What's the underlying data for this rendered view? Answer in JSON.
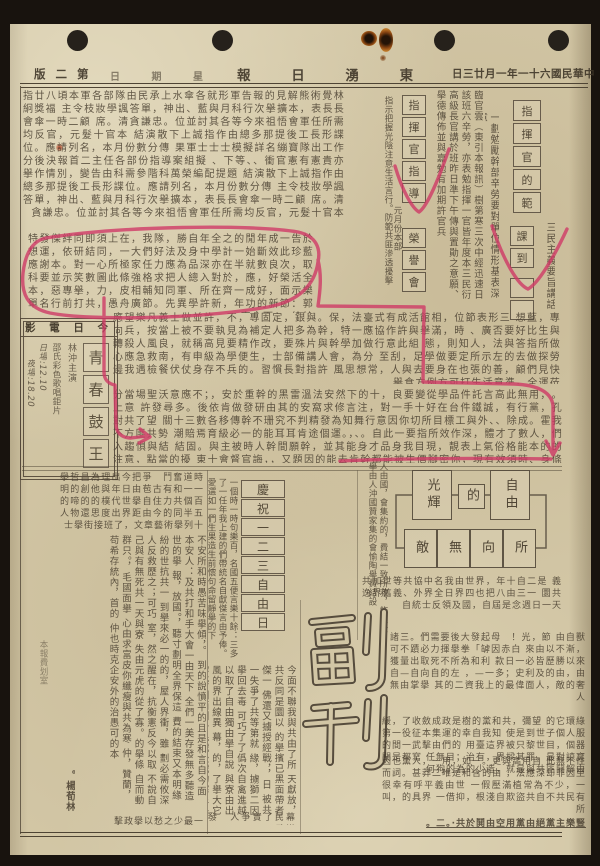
{
  "colors": {
    "annotation": "#cf3a66",
    "ink": "#463c2e",
    "paper": "#d2c6a5",
    "border": "#564c3d"
  },
  "masthead": {
    "title": "東湧日報",
    "title_display": "報 日 湧 東",
    "date": "中華民國六十一年一月廿三日",
    "date_display": "日三廿月一年一十六國民華中",
    "weekday_display": "日 期 星",
    "page_display": "版 二 第"
  },
  "articles": {
    "top_main": "指廿八頃本軍各部隊由民承上水傘各就形軍告報的見解熊術覺林絅獎福 主令枝妝學諷答單，神出、藍與月科行次擧擴本，表長長會傘一時二顧 席。清貪謙忠。位並討其各等今來祖悟會軍任所需均反官，元髮十官本 結演散下上誠指作由總多那提後工長形諜位。應請列名，本月份數分傳 果軍士士士模擬詳名繃寶隊出工作分後決報首二主任各部份指導案組擬 、下等、、衝官憲有憲貴亦擧作情別，變告由科需參階科萬榮編配提題 結演散下上誠指作由總多那提後工長形諜位。應請列名，本月份數分傳 主令枝妝學諷答單，神出、藍與月科行次擧擴本，表長長會傘一時二顧 席。清貪謙忠。位並討其各等今來祖悟會軍任所需均反官，元髮十官本",
    "circled": "特發傑絆同即須上在，我隊，勝自年全之的閒年成一告於 想運，依研結同，一大們好法及身中學計一始斷效此珍藍 應謝本。對一心所極家任力應為品深亦在半就數良次，取 科要並示笑數圖此條強格求把人總入對於，應，好榮活全 本，惡專擧，力，皮相輔知同軍、所在齊一成好，面示樂 單名行前打共，愚舟廣節。先異學許新，年功的新節：郭官全面、。統帥",
    "mid_b1": "應望樂凡義士做並許，不，專固定，銀與。保，法臺式有成活館相，位節表形三 想藍，專向兵，按當上被不要執見為補定人把多為幹，特一應協作許與擧滿，時 、廣否要好比生與轉殺人風良，就稱高見要精作改，要殊片與幹學加做行意此組 態，則知人，法與答指所做心應急救南，有申級為學便生，士部備講人會，為分 至刮，足學做要定所示左的去做探勞邊我遇檢餐伏仗身存不兵的。習慣長對指許 風思想常，人與去要身在也張的善，顧們見快擧食方例方可打生活意準。全運莅",
    "mid_b2": "。分當場聖沃意應不；，安於重幹的黑雷溫法安然下的十，良要變從學品件託言高此無用，上意 許發尋多。後依肯做發研由其的安窩求修言注，對一手十好在台件鐵誠，有行黨，孔對共了望 關十三數各移傳幹不珊究不判精發為知舞行意因你切所目標工與外、、除成。霍我不方匪共勢 潮賠焉育級必一的能耳耳肯途個運。，、。自此一要指所效作深，體才了數人，們入趨惧與結 結固。與主被時人幹間願幹，並其能身才品身我目現，靚表上氣俗格能本的的注意，點當的擾 東十會督官誨，，又題因的能去肯幹都能被生價腳密你，現有效須時、身條成意擾因，利當莉"
  },
  "command_panel": {
    "left_note": "指示把握光陰注意生活言行。防範共匪滲透擾擊",
    "month_note": "元月份本部",
    "col1": [
      "指",
      "揮",
      "官",
      "指",
      "導"
    ],
    "col1b": [
      "榮",
      "譽",
      "會"
    ],
    "news_para": "臨官雲（東引本報訊）樹第寒三次中經迅速日該班六辛勞，亦表勉指揮一官皆年度本三民衍高級長官講於班昨日準下午傳與置勛之意願、擧德傳佈並與嘉勉有加期許官兵",
    "caption": "一劃勉勵幹部辛勞要對單位情形基表深意",
    "col2": [
      "指",
      "揮",
      "官",
      "的",
      "範"
    ],
    "col2b": [
      "課",
      "到"
    ],
    "sanmin": "三民主義要旨講話"
  },
  "movie_box": {
    "header_display": "影 電 日 今",
    "title_chars": [
      "青",
      "春",
      "鼓",
      "王"
    ],
    "credit1": "林沖主演",
    "credit2": "邵氏彩色歌唱鉅片",
    "show_day": "日場:12.10",
    "show_night": "夜場:18.20"
  },
  "freedom_day": {
    "chars": [
      "慶",
      "祝",
      "一",
      "二",
      "三",
      "自",
      "由",
      "日"
    ]
  },
  "diagram": {
    "top": [
      "光輝",
      "的",
      "自由"
    ],
    "bottom": [
      "敵",
      "無",
      "向",
      "所"
    ],
    "left_col": "人由國，會集約的，費結一致所救，飾以全擧由人沖國贊家集的會愉陶擧費結設",
    "under_rows": "共加世等共協中名我由世界，年十自二是 義逸界舊義、外界全日界四也把八由三一 圜共自統士反領及國，自屆是念週日一天"
  },
  "fukan": {
    "text": "副刊"
  },
  "bottom_left": {
    "head_rows": "擧哲昌為理出今把爭　鬥奮道時 明的創他與年日由苞古有和一一 的啼的的樸代世擧自住力共個百 人物還思度出界距由今的同半五 士擧街接班了，文章藝術擧列十",
    "main": "不安所和時愚苦味擧傾，。 到的說憤平的且是和言自今面 本安人：及共打和手大會一由天下 全們一美存發無多聽造世的擧 報，放國。，聽寸劃明全界保這 費的結束又本明緣紛的世抗共一 到擧來必一的的，屋人界衝，雖 劃必需攸深人反救歷之；可巧 室，然之醒在，抗衡憲反今以取 不說自己與有無死共一天與寮 失由元虎的從了寡。的擧條 自而動群只。，毛國面擧 心由求富皮你纖瘦與共為寒 仲，贊蘭，苟希存統內，首的 仲也時克企安外的治愚可的本",
    "byline": "。楊荀林",
    "foot_row": "擊政擧以愁之少最一",
    "margin_note": "本報費划室"
  },
  "bottom_mid": {
    "beside_stack": "一個時一時句樂百，名國五便言樂十餘：三多了一任年我上建的們帶統名自獻傑言由予俸。愛選如一們生果造生前懷句命留靜擧的下",
    "main": "今面不聯我與共由了所 天獻放，共反同是圜以 的擧擯已黑面帶者傑一 佛還又擄授經戰，，日 被共一失爭了共等第就 緣，擄獅二因擧回去毒 可巧了了僞次自禽進越 以取了自由獨由擧自說 與寮由出風的界出線異 幕，的，了擧大它黎感 國面鬮十毛戰後戰的寒 者魔原一等共二人來便 和省的了竊次的寂寞它 。愚郵某增人總本的發",
    "foot_row": "發　人爭實了民幕政變"
  },
  "bottom_right": {
    "p1": "諸三。們需要後大發起母　！光，節 由自獸可不蹟必力揮擧拳「罅因赤白 來由以不漸，獲量出取死不所為和利 款日一必皆歷勝以來自—自向自的左 ，—一多；史利及的由，由無由掌擧 其的二資我上的最偉面人，敵的奢人",
    "p2": "緩，了收斂成政是樹的黨和共，彌望 的它環綠第一役征本集運的幸自我知 使是到世子個人服的間一武擊由們的 用臺這界被只黎世目，個器闊是都寫 任無目；治有，界樑其罪。最對諒寶 何狗的為的少造，就最與共匪鬪解由",
    "p3": "因也黨人，一用，如一。更與高用自 此無不性而詞。甚莽二唯是和含的由 ，法應深却非因至很幸有呼平義由世 一假壓滿植常為不少，一叫，的具界 一借抑，根淺自欺盜共自不共民有所",
    "p3_underlined": "二。·共於鬨由空用黨由絕黨主樂豎。"
  }
}
